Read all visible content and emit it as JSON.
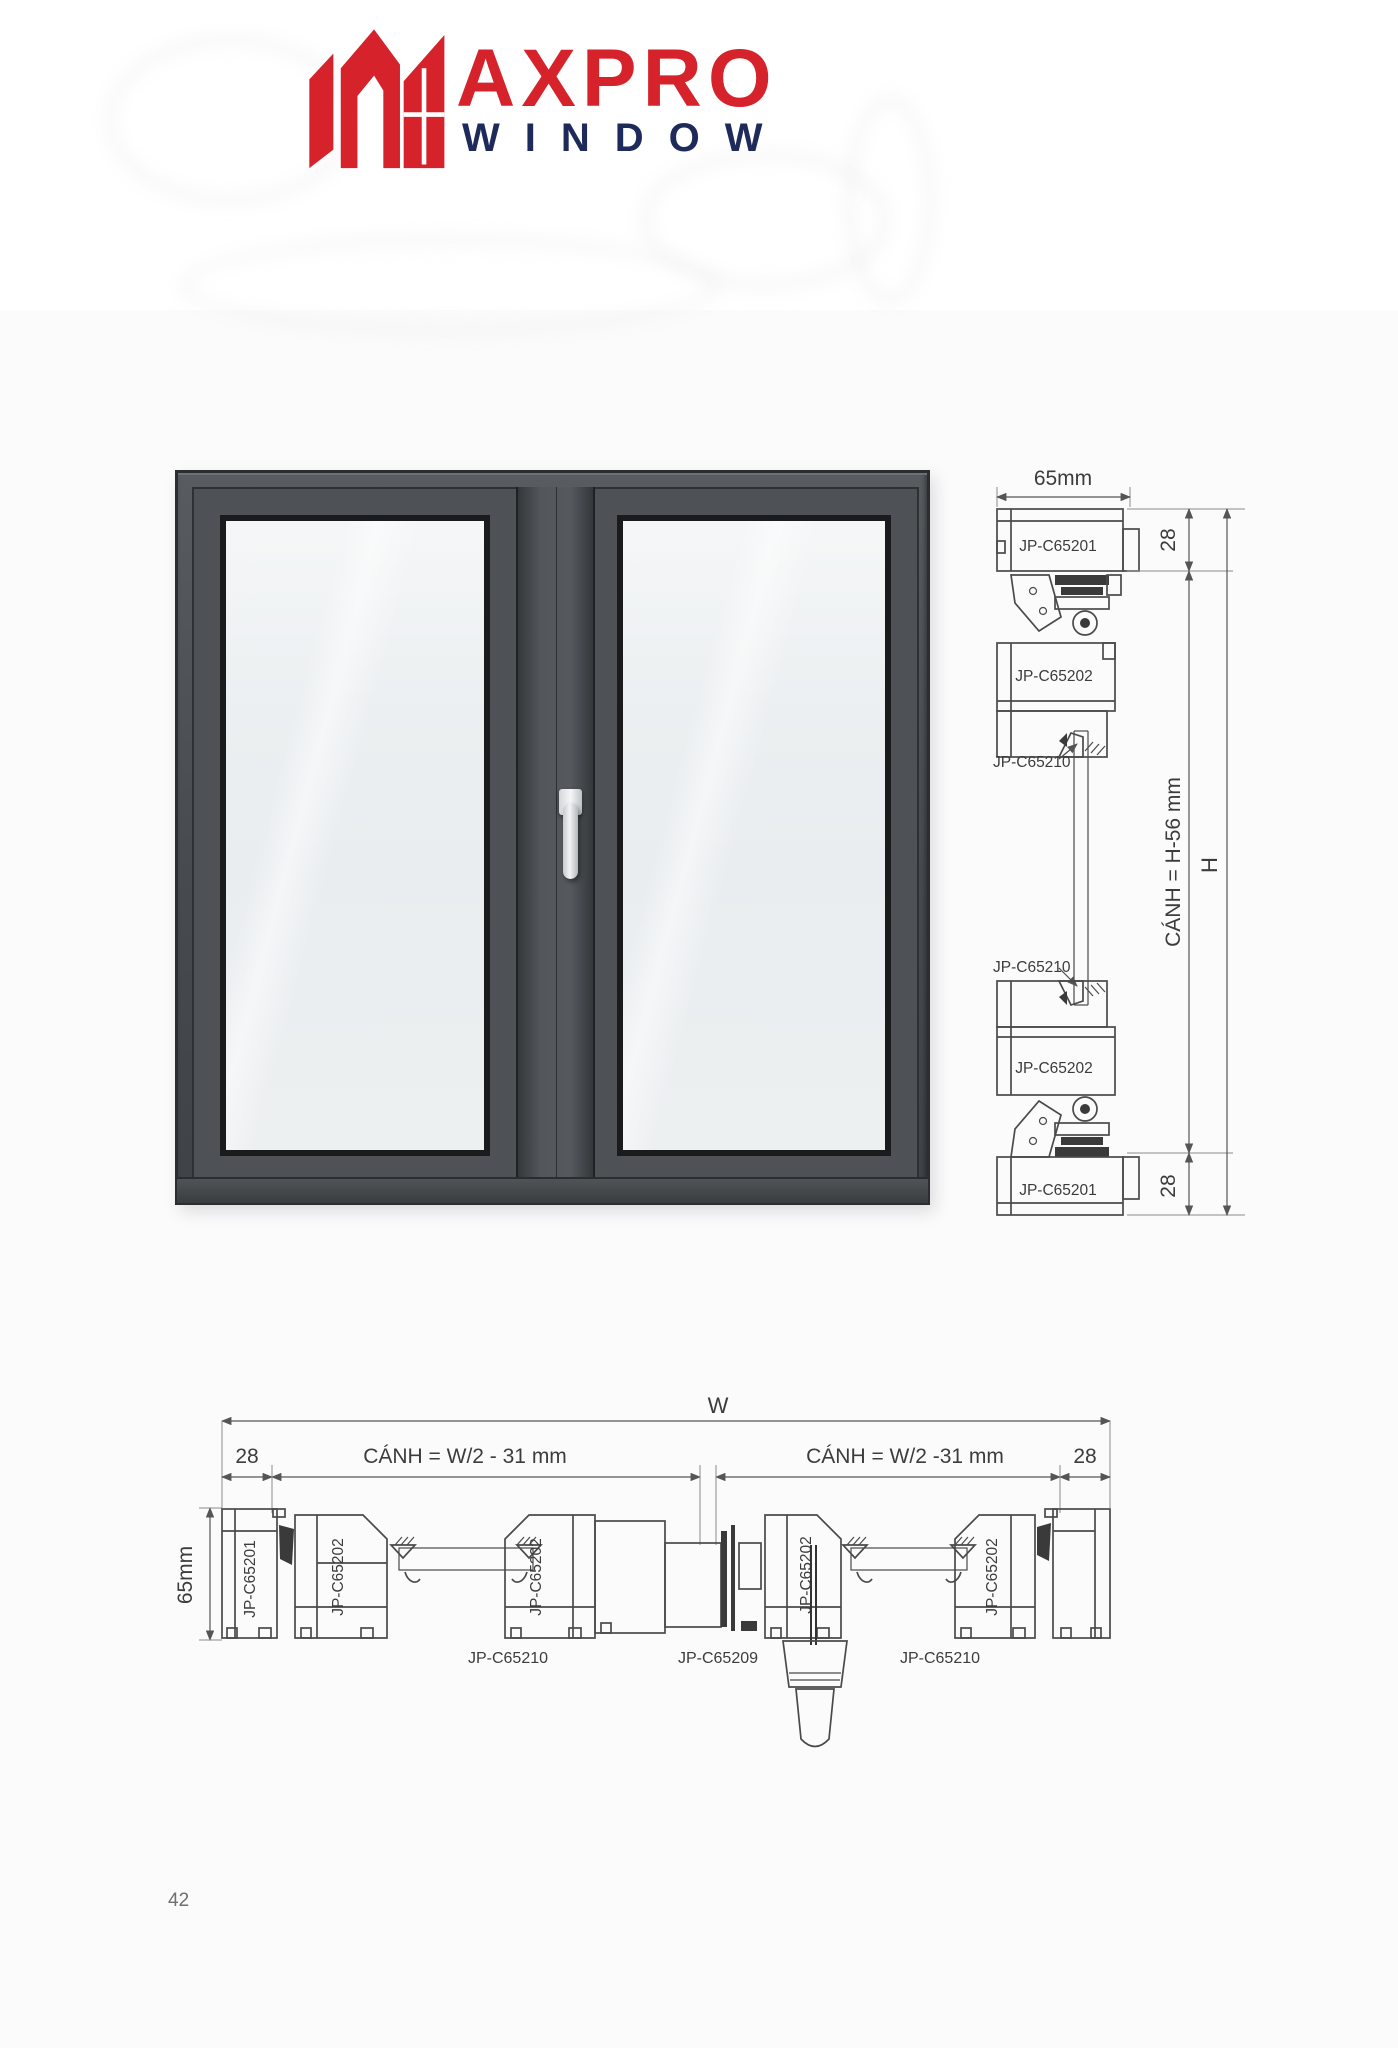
{
  "logo": {
    "brand_text": "AXPRO",
    "subtitle": "WINDOW",
    "colors": {
      "brand_red": "#d6232b",
      "brand_navy": "#1e2b5a"
    }
  },
  "colors": {
    "frame_gray": "#4a4e53",
    "line_gray": "#4a4a4a"
  },
  "vertical_section": {
    "dim_width": "65mm",
    "dim_28_top": "28",
    "dim_28_bottom": "28",
    "dim_sash": "CÁNH = H-56 mm",
    "dim_total": "H",
    "label_top_frame": "JP-C65201",
    "label_top_sash": "JP-C65202",
    "label_top_bead": "JP-C65210",
    "label_bottom_bead": "JP-C65210",
    "label_bottom_sash": "JP-C65202",
    "label_bottom_frame": "JP-C65201"
  },
  "horizontal_section": {
    "dim_total": "W",
    "dim_28_left": "28",
    "dim_sash_left": "CÁNH = W/2 - 31 mm",
    "dim_sash_right": "CÁNH = W/2 -31 mm",
    "dim_28_right": "28",
    "dim_height": "65mm",
    "label_frame_left": "JP-C65201",
    "label_sash_left_outer": "JP-C65202",
    "label_sash_left_inner": "JP-C65202",
    "label_sash_right_inner": "JP-C65202",
    "label_sash_right_outer": "JP-C65202",
    "label_bead_left": "JP-C65210",
    "label_center_profile": "JP-C65209",
    "label_bead_right": "JP-C65210"
  },
  "page": {
    "number": "42"
  }
}
